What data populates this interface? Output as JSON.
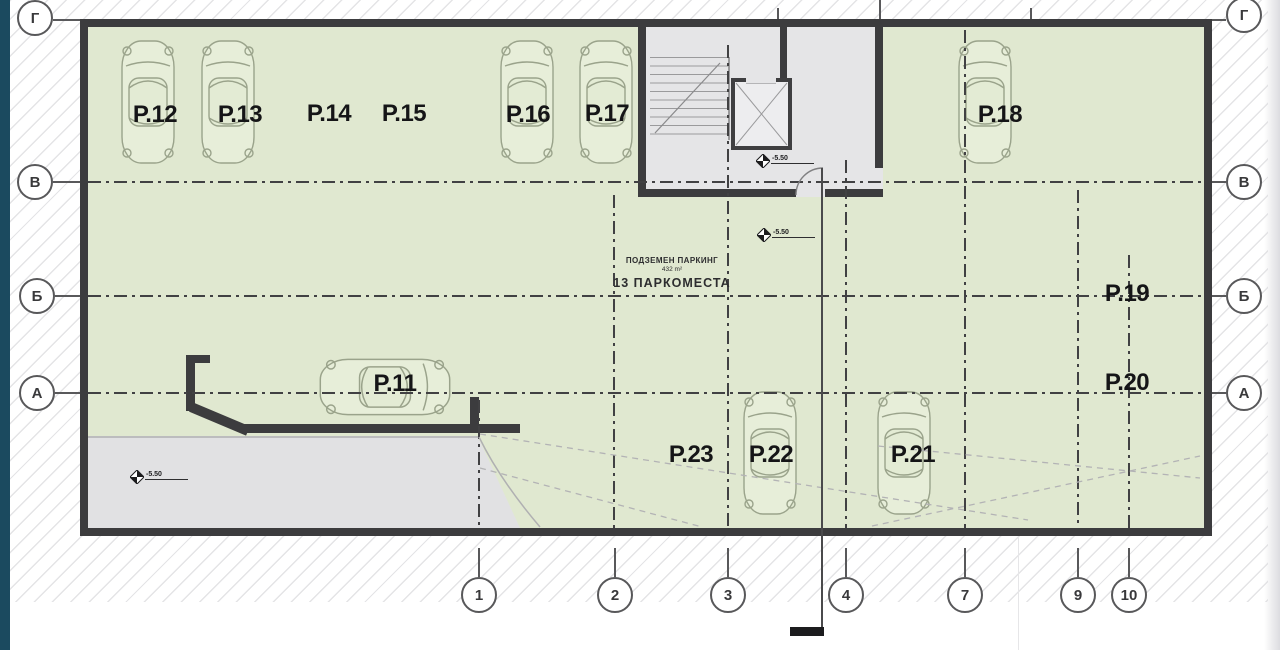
{
  "plan": {
    "annotation": {
      "line1": "ПОДЗЕМЕН ПАРКИНГ",
      "line2": "432 m²",
      "line3": "13 ПАРКОМЕСТА"
    },
    "spots": [
      {
        "label": "P.12"
      },
      {
        "label": "P.13"
      },
      {
        "label": "P.14"
      },
      {
        "label": "P.15"
      },
      {
        "label": "P.16"
      },
      {
        "label": "P.17"
      },
      {
        "label": "P.18"
      },
      {
        "label": "P.11"
      },
      {
        "label": "P.19"
      },
      {
        "label": "P.20"
      },
      {
        "label": "P.23"
      },
      {
        "label": "P.22"
      },
      {
        "label": "P.21"
      }
    ],
    "row_axes": [
      "Г",
      "В",
      "Б",
      "А"
    ],
    "col_axes": [
      "1",
      "2",
      "3",
      "4",
      "7",
      "9",
      "10"
    ],
    "level_markers": {
      "core": "-5.50",
      "mid": "-5.50",
      "ramp": "-5.50"
    },
    "colors": {
      "accent_teal": "#1b4a5f",
      "floor_green": "#e0e8d0",
      "wall_dark": "#3c3c3e",
      "core_gray": "#e5e5e7",
      "ramp_gray": "#e1e1e3"
    }
  }
}
